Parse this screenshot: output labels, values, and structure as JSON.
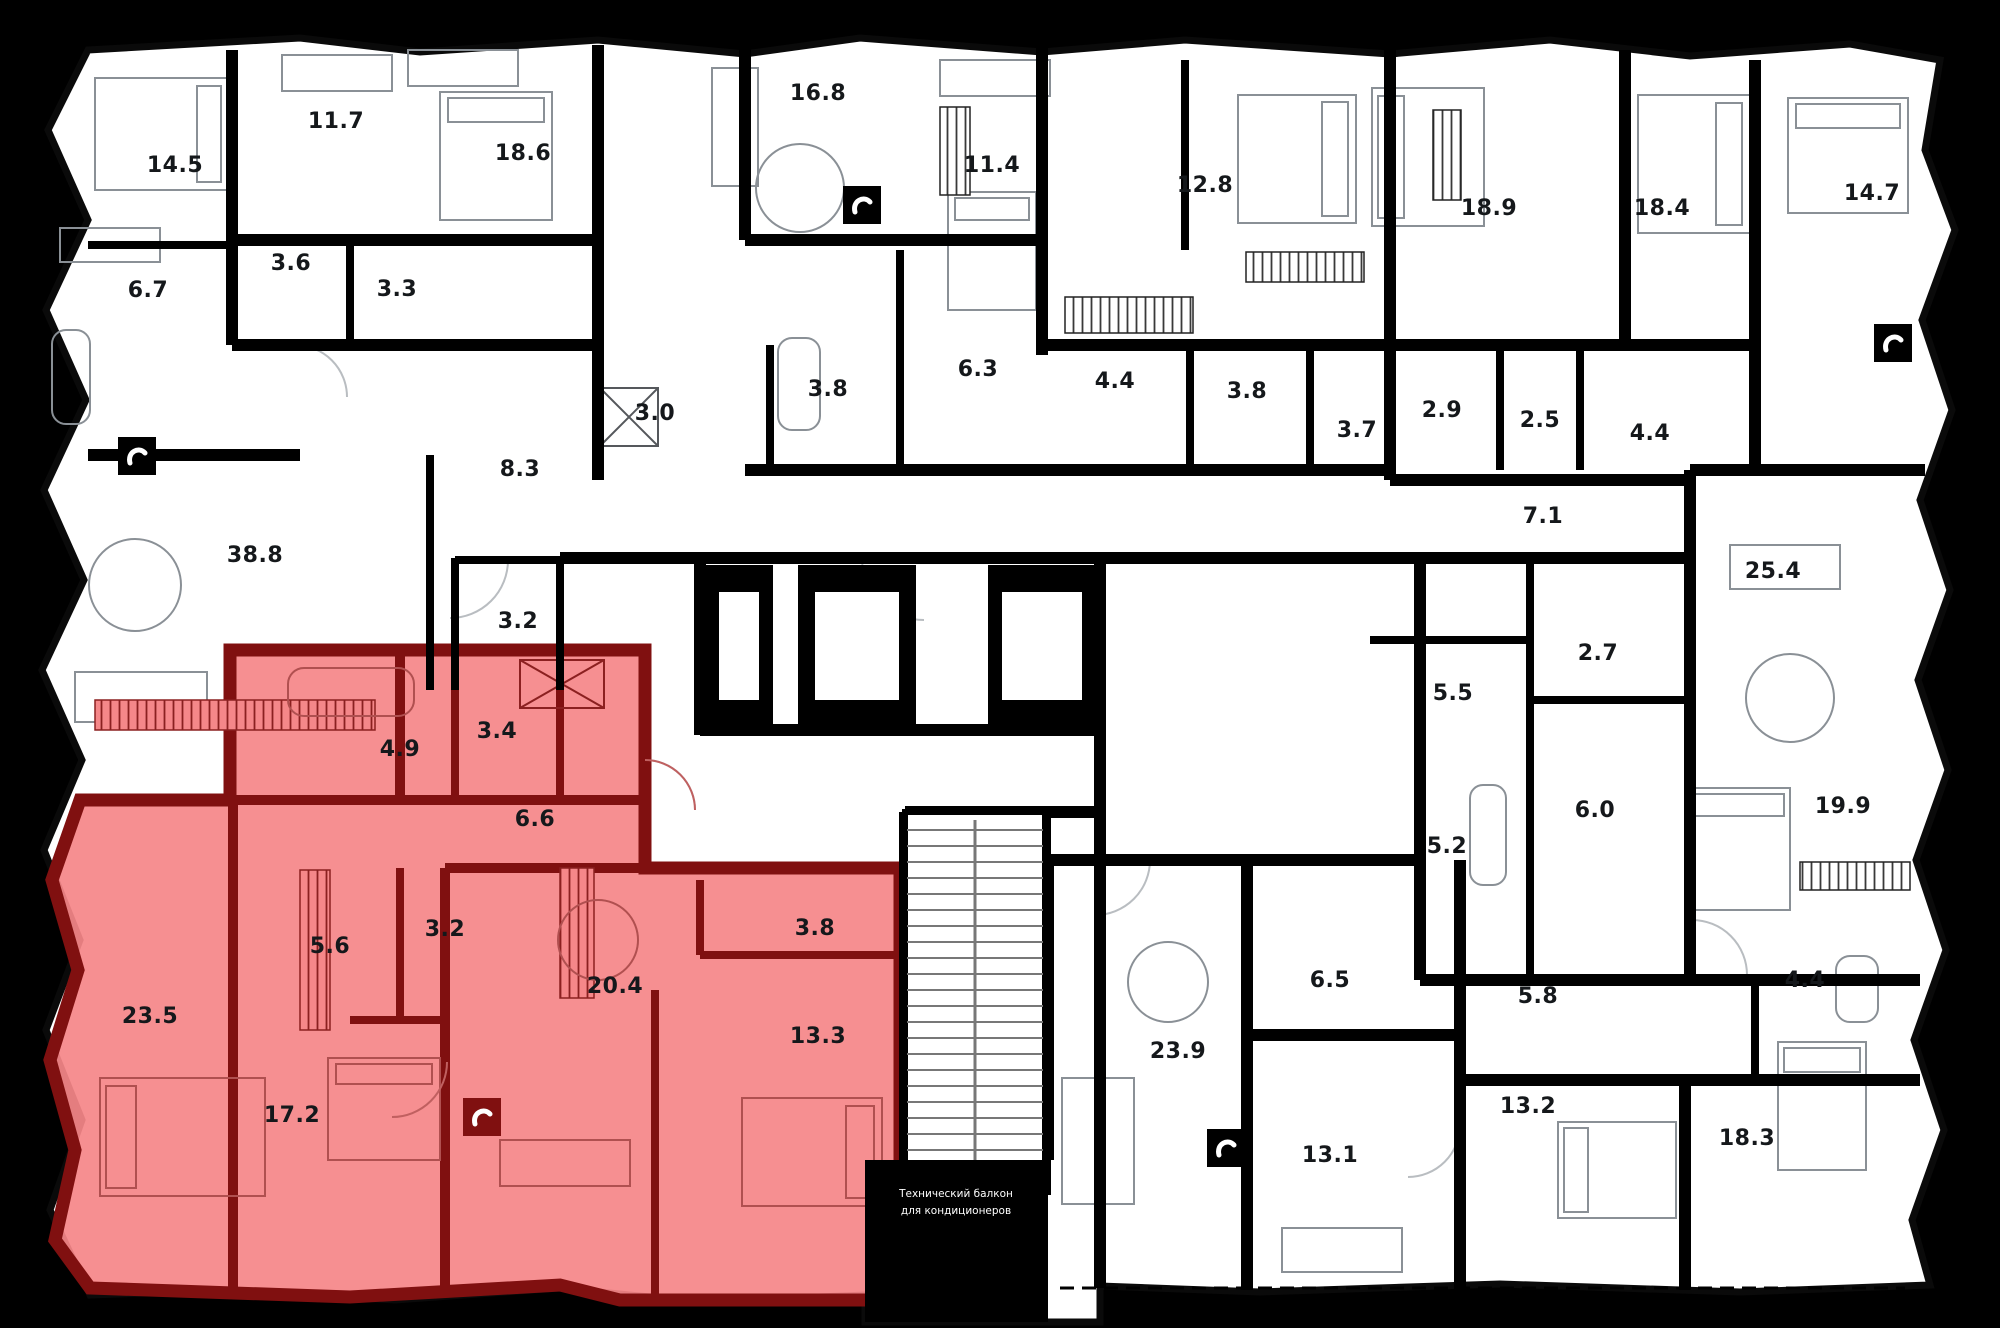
{
  "canvas": {
    "width": 2000,
    "height": 1328
  },
  "colors": {
    "background": "#000000",
    "floor": "#ffffff",
    "wall": "#000000",
    "highlight_fill": "#f58789",
    "highlight_wall": "#801010"
  },
  "note": {
    "line1": "Технический балкон",
    "line2": "для кондиционеров"
  },
  "rooms": [
    {
      "area": "14.5",
      "x": 175,
      "y": 172,
      "highlighted": false
    },
    {
      "area": "11.7",
      "x": 336,
      "y": 128,
      "highlighted": false
    },
    {
      "area": "18.6",
      "x": 523,
      "y": 160,
      "highlighted": false
    },
    {
      "area": "16.8",
      "x": 818,
      "y": 100,
      "highlighted": false
    },
    {
      "area": "11.4",
      "x": 992,
      "y": 172,
      "highlighted": false
    },
    {
      "area": "12.8",
      "x": 1205,
      "y": 192,
      "highlighted": false
    },
    {
      "area": "18.9",
      "x": 1489,
      "y": 215,
      "highlighted": false
    },
    {
      "area": "18.4",
      "x": 1662,
      "y": 215,
      "highlighted": false
    },
    {
      "area": "14.7",
      "x": 1872,
      "y": 200,
      "highlighted": false
    },
    {
      "area": "6.7",
      "x": 148,
      "y": 297,
      "highlighted": false
    },
    {
      "area": "3.6",
      "x": 291,
      "y": 270,
      "highlighted": false
    },
    {
      "area": "3.3",
      "x": 397,
      "y": 296,
      "highlighted": false
    },
    {
      "area": "8.3",
      "x": 520,
      "y": 476,
      "highlighted": false
    },
    {
      "area": "3.0",
      "x": 655,
      "y": 420,
      "highlighted": false
    },
    {
      "area": "3.2",
      "x": 518,
      "y": 628,
      "highlighted": false
    },
    {
      "area": "38.8",
      "x": 255,
      "y": 562,
      "highlighted": false
    },
    {
      "area": "3.8",
      "x": 828,
      "y": 396,
      "highlighted": false
    },
    {
      "area": "6.3",
      "x": 978,
      "y": 376,
      "highlighted": false
    },
    {
      "area": "4.4",
      "x": 1115,
      "y": 388,
      "highlighted": false
    },
    {
      "area": "3.8",
      "x": 1247,
      "y": 398,
      "highlighted": false
    },
    {
      "area": "3.7",
      "x": 1357,
      "y": 437,
      "highlighted": false
    },
    {
      "area": "2.9",
      "x": 1442,
      "y": 417,
      "highlighted": false
    },
    {
      "area": "2.5",
      "x": 1540,
      "y": 427,
      "highlighted": false
    },
    {
      "area": "4.4",
      "x": 1650,
      "y": 440,
      "highlighted": false
    },
    {
      "area": "7.1",
      "x": 1543,
      "y": 523,
      "highlighted": false
    },
    {
      "area": "25.4",
      "x": 1773,
      "y": 578,
      "highlighted": false
    },
    {
      "area": "5.5",
      "x": 1453,
      "y": 700,
      "highlighted": false
    },
    {
      "area": "2.7",
      "x": 1598,
      "y": 660,
      "highlighted": false
    },
    {
      "area": "5.2",
      "x": 1447,
      "y": 853,
      "highlighted": false
    },
    {
      "area": "6.0",
      "x": 1595,
      "y": 817,
      "highlighted": false
    },
    {
      "area": "19.9",
      "x": 1843,
      "y": 813,
      "highlighted": false
    },
    {
      "area": "6.5",
      "x": 1330,
      "y": 987,
      "highlighted": false
    },
    {
      "area": "5.8",
      "x": 1538,
      "y": 1003,
      "highlighted": false
    },
    {
      "area": "4.4",
      "x": 1805,
      "y": 987,
      "highlighted": false
    },
    {
      "area": "23.9",
      "x": 1178,
      "y": 1058,
      "highlighted": false
    },
    {
      "area": "13.1",
      "x": 1330,
      "y": 1162,
      "highlighted": false
    },
    {
      "area": "13.2",
      "x": 1528,
      "y": 1113,
      "highlighted": false
    },
    {
      "area": "18.3",
      "x": 1747,
      "y": 1145,
      "highlighted": false
    },
    {
      "area": "4.9",
      "x": 400,
      "y": 756,
      "highlighted": true
    },
    {
      "area": "3.4",
      "x": 497,
      "y": 738,
      "highlighted": true
    },
    {
      "area": "6.6",
      "x": 535,
      "y": 826,
      "highlighted": true
    },
    {
      "area": "5.6",
      "x": 330,
      "y": 953,
      "highlighted": true
    },
    {
      "area": "3.2",
      "x": 445,
      "y": 936,
      "highlighted": true
    },
    {
      "area": "23.5",
      "x": 150,
      "y": 1023,
      "highlighted": true
    },
    {
      "area": "17.2",
      "x": 292,
      "y": 1122,
      "highlighted": true
    },
    {
      "area": "20.4",
      "x": 615,
      "y": 993,
      "highlighted": true
    },
    {
      "area": "3.8",
      "x": 815,
      "y": 935,
      "highlighted": true
    },
    {
      "area": "13.3",
      "x": 818,
      "y": 1043,
      "highlighted": true
    }
  ],
  "icons": [
    {
      "name": "utility-icon",
      "x": 862,
      "y": 205,
      "variant": "black"
    },
    {
      "name": "utility-icon",
      "x": 137,
      "y": 456,
      "variant": "black"
    },
    {
      "name": "utility-icon",
      "x": 1893,
      "y": 343,
      "variant": "black"
    },
    {
      "name": "utility-icon",
      "x": 482,
      "y": 1117,
      "variant": "red"
    },
    {
      "name": "utility-icon",
      "x": 1226,
      "y": 1148,
      "variant": "black"
    }
  ]
}
